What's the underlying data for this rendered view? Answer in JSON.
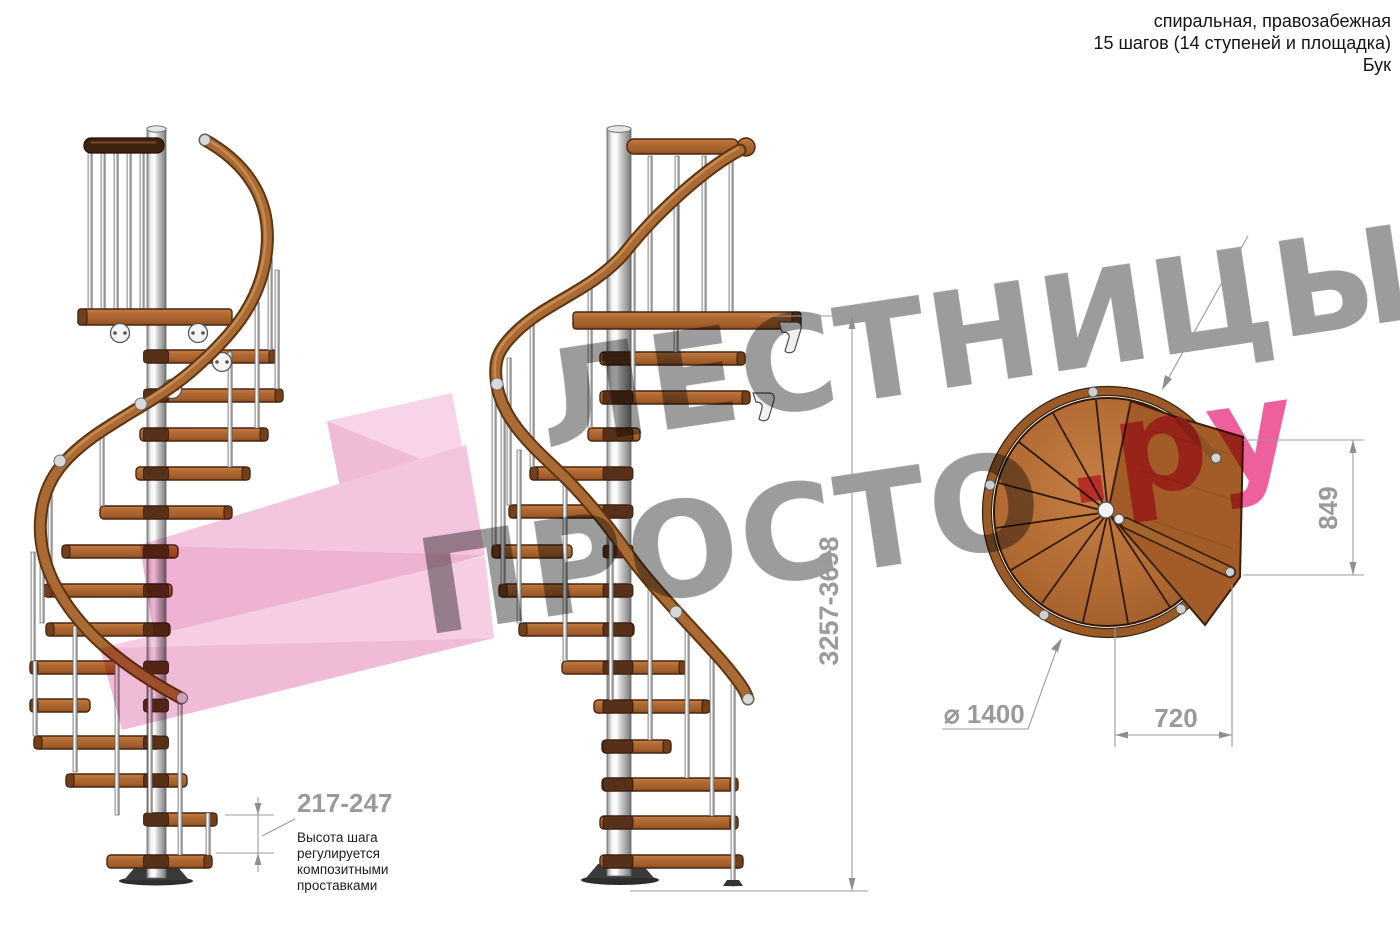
{
  "header": {
    "line1": "спиральная, правозабежная",
    "line2": "15 шагов (14 ступеней и площадка)",
    "line3": "Бук"
  },
  "watermark": {
    "line1": "ЛЕСТНИЦЫ",
    "line2_gray": "ПРОСТО",
    "line2_pink": ".ру"
  },
  "dimensions": {
    "total_height": "3257-3698",
    "step_height": "217-247",
    "landing_depth": "849",
    "landing_width": "720",
    "diameter": "⌀ 1400"
  },
  "annotations": {
    "step_note_lines": {
      "0": "Высота шага",
      "1": "регулируется",
      "2": "композитными",
      "3": "проставками"
    }
  },
  "colors": {
    "wood": "#b06a32",
    "wood_dark": "#73401b",
    "handrail": "#a96a33",
    "metal_pole": "#c9c9c9",
    "dim_gray": "#9a9a9a",
    "watermark_gray": "#9c9c9c",
    "watermark_pink": "#ee5f9e",
    "arrow_pink": "#f4c3de",
    "text_black": "#1c1c1c"
  }
}
